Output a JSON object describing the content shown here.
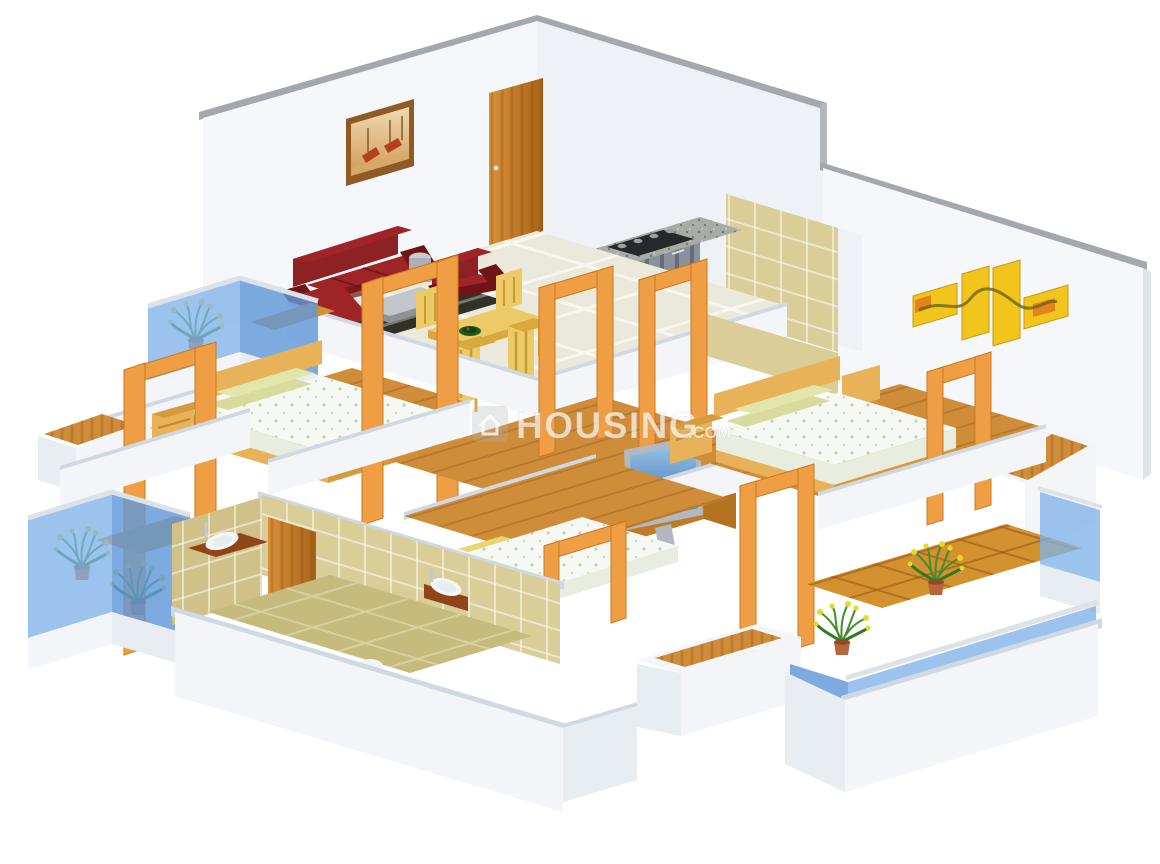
{
  "watermark": {
    "logo": "house-icon",
    "text": "HOUSING",
    "suffix": ".COM"
  },
  "palette": {
    "wallFace": "#f5f7fa",
    "wallShade": "#eef1f5",
    "wallCap": "#a3a8ae",
    "lowCap": "#cfd9e3",
    "plinth": "#f3f5f8",
    "plinthShade": "#e8edf2",
    "tile": "#ebe9db",
    "wood": "#cf8d3a",
    "woodDark": "#c07b28",
    "bathWall": "#dacd98",
    "bathWallShade": "#cfc187",
    "bathFloor": "#c6ba7d",
    "glass": "#7fb2e8",
    "glassDeep": "#6099d8",
    "rail": "#dde2e8",
    "balconyTile": "#d3912f",
    "portal": "#f09e44",
    "portalDark": "#c9791f",
    "entranceDoor": "#c77c1f",
    "sofa": "#8e2124",
    "sofaDark": "#6f1417",
    "sofaLight": "#9e2427",
    "dining": "#ecca67",
    "diningDark": "#d7a93e",
    "bedWood": "#e8b258",
    "bedWoodDark": "#d89a3c",
    "pillow": "#d7dc9e",
    "pillowLight": "#e2e6ab",
    "mattress": "#f6f8f3",
    "mattressShade": "#e8ede0",
    "granite": "#a9aca6",
    "graniteDark": "#8f938e",
    "cabinet": "#8a919a",
    "hob": "#26282a",
    "tvFrame": "#b2b8bf",
    "artYellow": "#f2c51d",
    "artOrange": "#e2761e",
    "paintingFrame": "#8f5a26",
    "boat": "#b5401d",
    "plantGreen": "#3f8f2c",
    "flowerYellow": "#ead826",
    "pot": "#b5663a",
    "rug": "#30322a",
    "counter": "#8f4517",
    "watermark": "#ffffff"
  },
  "scene": {
    "type": "isometric-3d-floor-plan",
    "unit_layout": "3-bedroom apartment render",
    "rooms": [
      {
        "name": "living-dining-room",
        "floor": "cream ceramic tiles",
        "items": [
          "maroon leather sofa with chaise",
          "maroon armchair",
          "steel drum side table",
          "glass-top coffee table",
          "dark striped rug",
          "gondola wall painting",
          "wooden entrance door",
          "yellow dining table with four chairs",
          "green fruit bowl"
        ]
      },
      {
        "name": "kitchen",
        "floor": "cream ceramic tiles",
        "items": [
          "granite counter",
          "four-burner gas hob",
          "grey shutter cabinets"
        ]
      },
      {
        "name": "toilet",
        "floor": "terracotta patch",
        "items": [
          "white commode",
          "khaki wall tiles"
        ]
      },
      {
        "name": "bedroom-1",
        "floor": "wooden planks",
        "items": [
          "double bed",
          "green pillows",
          "printed white mattress",
          "wooden headboard",
          "bedside drawer unit",
          "open wooden door frames"
        ]
      },
      {
        "name": "passage-hall",
        "floor": "wooden planks",
        "items": [
          "flat screen tv with sky image",
          "wooden tv cabinet"
        ]
      },
      {
        "name": "master-bedroom",
        "floor": "wooden planks",
        "items": [
          "double bed",
          "green pillows",
          "bedside drawer units",
          "four-panel yellow abstract wall art",
          "wooden window ledge"
        ]
      },
      {
        "name": "bedroom-2",
        "floor": "wooden planks",
        "items": [
          "double bed",
          "wooden side frame"
        ]
      },
      {
        "name": "bathroom",
        "floor": "khaki tiles",
        "items": [
          "counter wash basin",
          "wall basin",
          "wooden door",
          "khaki wall tiles",
          "floor arc cutout"
        ]
      }
    ],
    "balconies": [
      {
        "name": "balcony-top-left",
        "items": [
          "blue glass railing",
          "flowering plant",
          "terracotta tile floor"
        ]
      },
      {
        "name": "balcony-left",
        "items": [
          "blue glass railing",
          "two flowering plants",
          "terracotta tile floor"
        ]
      },
      {
        "name": "balcony-right",
        "items": [
          "blue glass railing",
          "two flowering plants",
          "terracotta tile floor"
        ]
      }
    ]
  }
}
